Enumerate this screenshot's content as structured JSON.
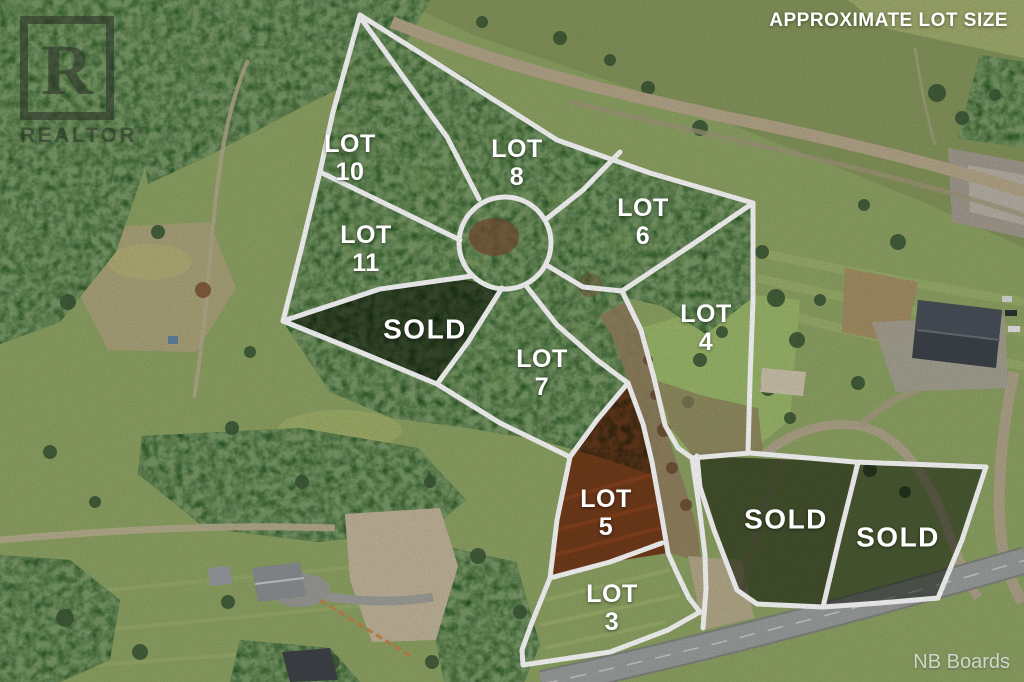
{
  "header": {
    "title": "APPROXIMATE LOT SIZE"
  },
  "credit": {
    "text": "NB Boards"
  },
  "watermark": {
    "letter": "R",
    "brand": "REALTOR",
    "registered": "®"
  },
  "lots": {
    "lot10": {
      "line1": "LOT",
      "line2": "10",
      "status": "available"
    },
    "lot8": {
      "line1": "LOT",
      "line2": "8",
      "status": "available"
    },
    "lot6": {
      "line1": "LOT",
      "line2": "6",
      "status": "available"
    },
    "lot11": {
      "line1": "LOT",
      "line2": "11",
      "status": "available"
    },
    "lot4": {
      "line1": "LOT",
      "line2": "4",
      "status": "available"
    },
    "lot7": {
      "line1": "LOT",
      "line2": "7",
      "status": "available"
    },
    "lot5": {
      "line1": "LOT",
      "line2": "5",
      "status": "highlighted"
    },
    "lot3": {
      "line1": "LOT",
      "line2": "3",
      "status": "available"
    },
    "sold_center": {
      "label": "SOLD"
    },
    "sold_east": {
      "label": "SOLD"
    },
    "sold_far_east": {
      "label": "SOLD"
    }
  },
  "colors": {
    "boundary_line": "#ffffff",
    "lot5_highlight": "#c23818",
    "sold_overlay": "#16220c",
    "label_text": "#ffffff",
    "watermark_gray": "#2a3028",
    "credit_gray": "#e6e9e6"
  }
}
